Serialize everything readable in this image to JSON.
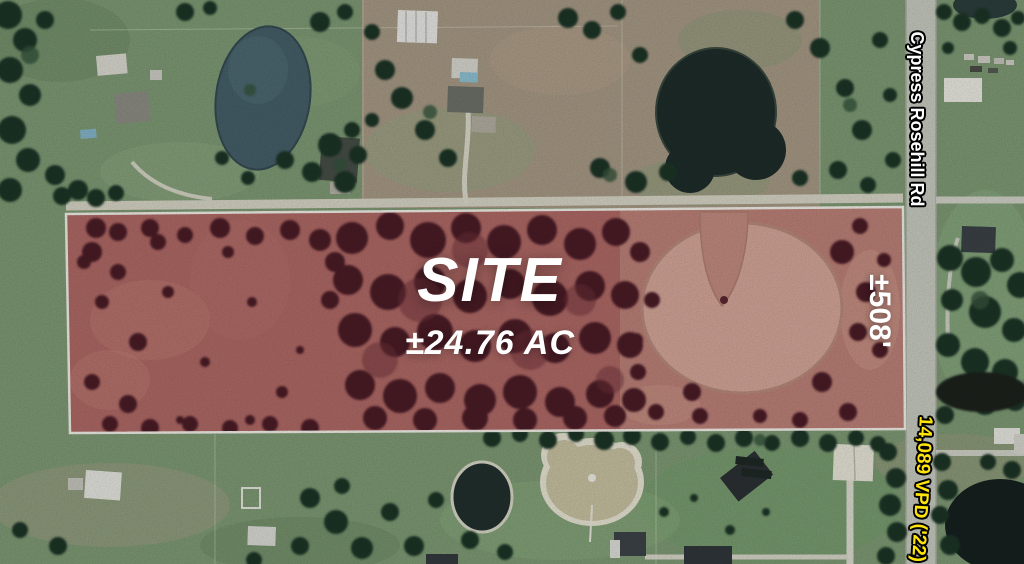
{
  "annotations": {
    "site_label": "SITE",
    "site_acreage": "±24.76 AC",
    "site_frontage": "±508'",
    "road_name": "Cypress Rosehill Rd",
    "traffic_count": "14,089 VPD ('22)"
  },
  "colors": {
    "label_white": "#ffffff",
    "traffic_yellow": "#ffe40a",
    "site_border": "#f4f1ea",
    "site_tint": "#a8605e",
    "road_gray": "#c9ccc1"
  }
}
